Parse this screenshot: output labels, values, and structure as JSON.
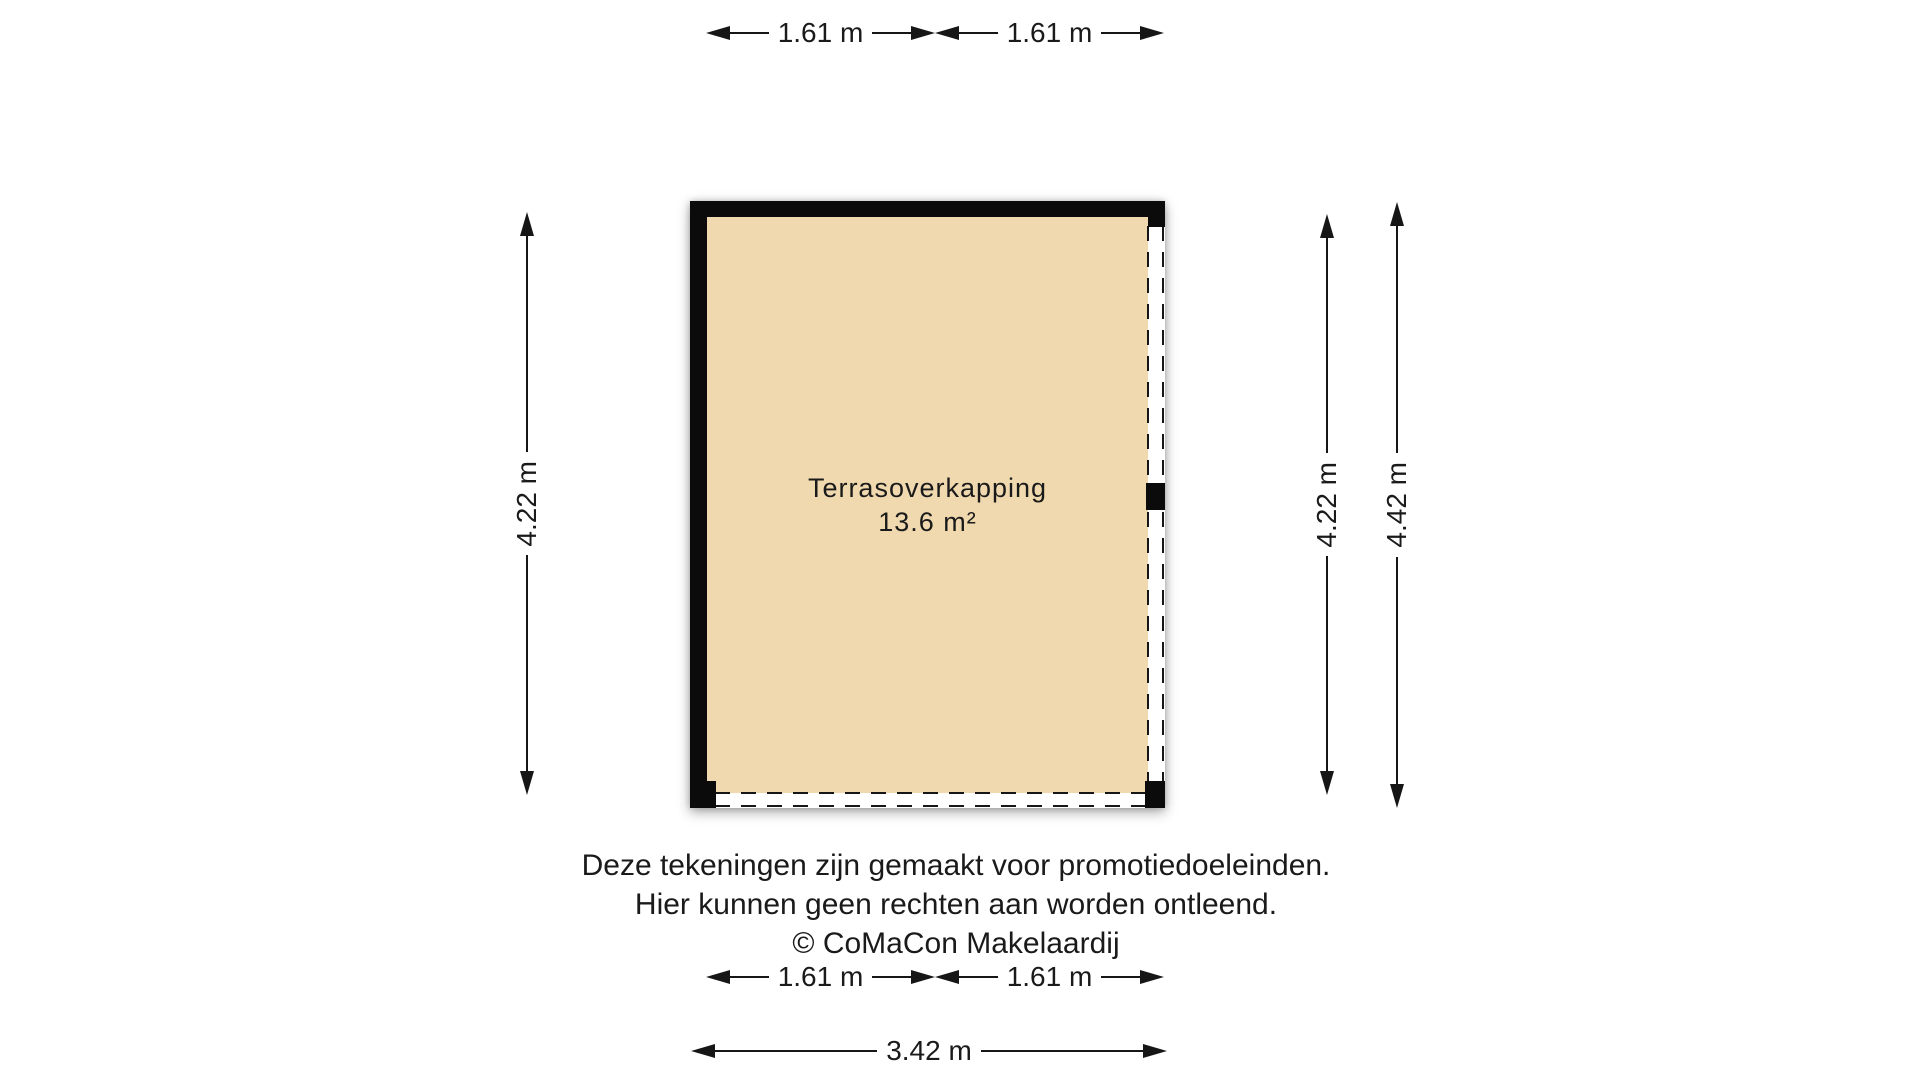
{
  "room": {
    "name": "Terrasoverkapping",
    "area": "13.6 m²"
  },
  "dims": {
    "top": [
      "1.61 m",
      "1.61 m"
    ],
    "left": "4.22 m",
    "right_inner": "4.22 m",
    "right_outer": "4.42 m",
    "bottom": [
      "1.61 m",
      "1.61 m"
    ],
    "bottom_total": "3.42 m"
  },
  "disclaimer": [
    "Deze tekeningen zijn gemaakt voor promotiedoeleinden.",
    "Hier kunnen geen rechten aan worden ontleend.",
    "© CoMaCon Makelaardij"
  ],
  "colors": {
    "floor_fill": "#f0d9ae",
    "wall": "#0b0b0b",
    "line_text": "#1a1a1a",
    "background": "#ffffff"
  }
}
